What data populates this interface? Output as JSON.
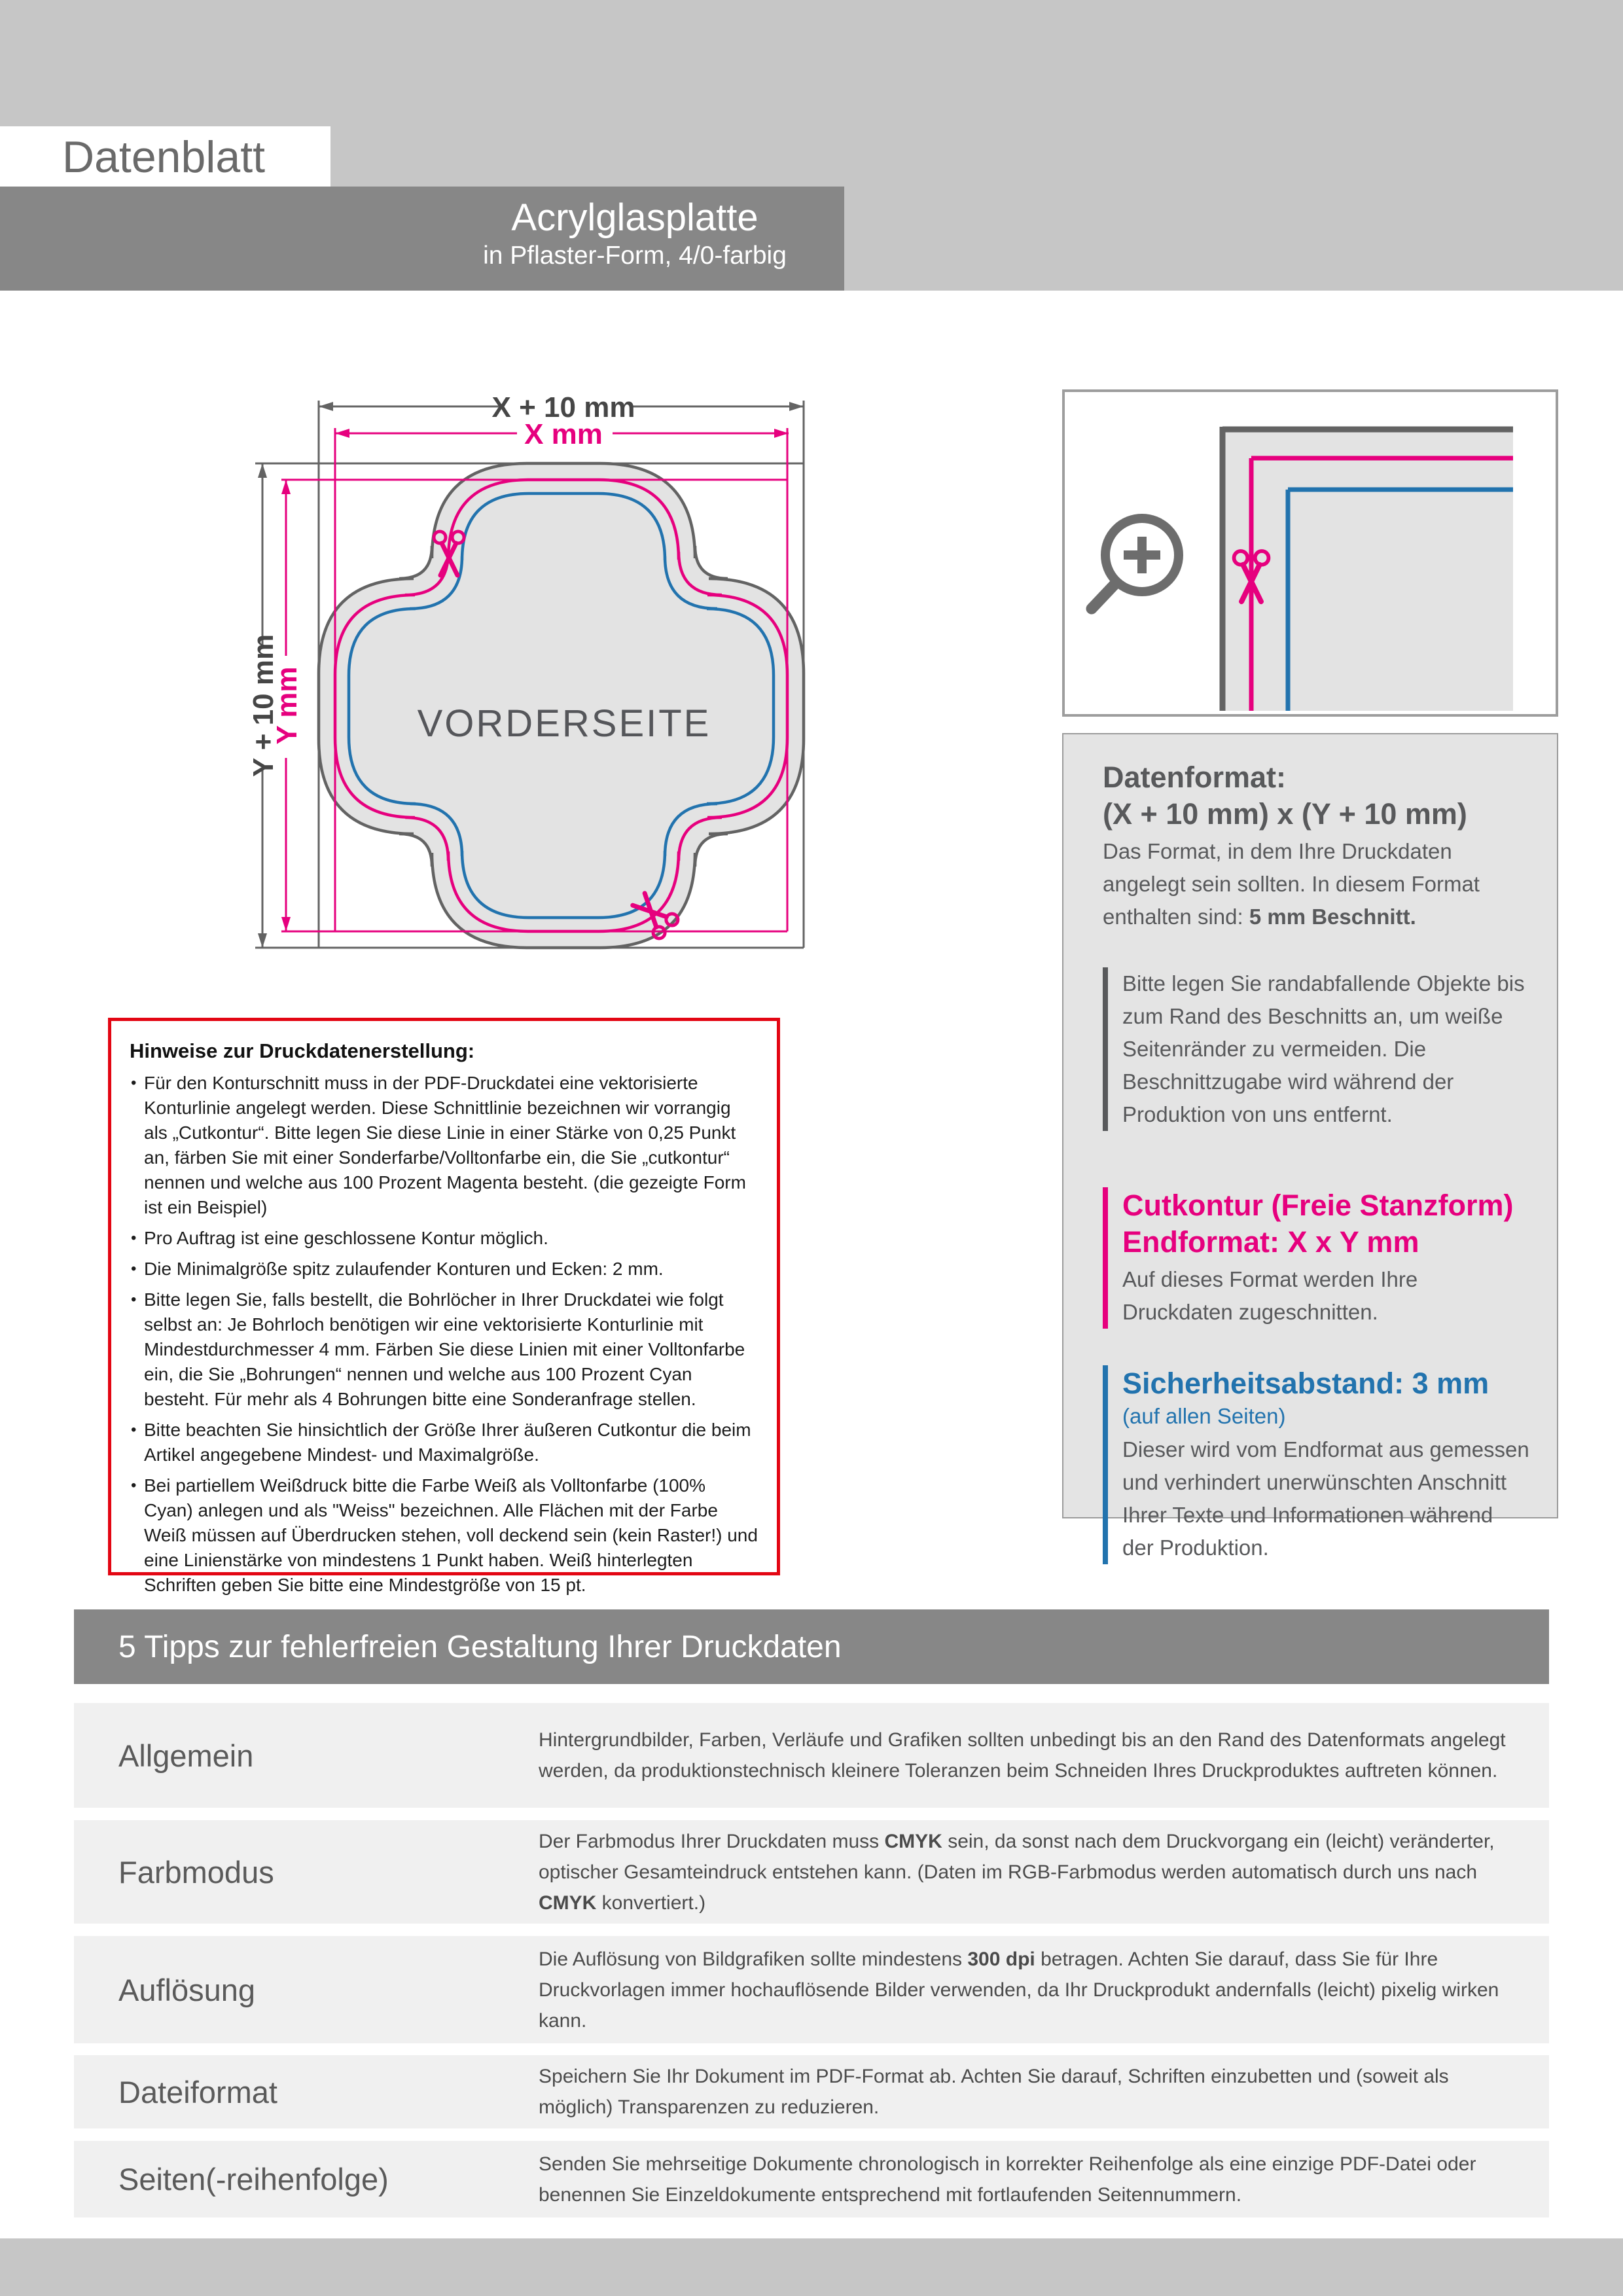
{
  "page": {
    "eyebrow": "Datenblatt",
    "title": "Acrylglasplatte",
    "subtitle": "in Pflaster-Form, 4/0-farbig"
  },
  "diagram": {
    "dim_outer_width": "X + 10 mm",
    "dim_inner_width": "X mm",
    "dim_outer_height": "Y + 10 mm",
    "dim_inner_height": "Y mm",
    "front_label": "VORDERSEITE"
  },
  "info_panel": {
    "datenformat_title": "Datenformat:",
    "datenformat_formula": "(X + 10 mm) x (Y + 10 mm)",
    "datenformat_segments": [
      {
        "t": "Das Format, in dem Ihre Druckdaten angelegt sein sollten. In diesem Format enthalten sind: ",
        "b": false
      },
      {
        "t": "5 mm Beschnitt.",
        "b": true
      }
    ],
    "bleed_note": "Bitte legen Sie randabfallende Objekte bis zum Rand des Beschnitts an, um weiße Seitenränder zu vermeiden. Die Beschnittzugabe wird während der Produktion von uns entfernt.",
    "cutkontur_title": "Cutkontur (Freie Stanzform)",
    "cutkontur_subtitle": "Endformat: X x Y mm",
    "cutkontur_text": "Auf dieses Format werden Ihre Druckdaten zugeschnitten.",
    "safety_title": "Sicherheitsabstand: 3 mm",
    "safety_scope": "(auf allen Seiten)",
    "safety_text": "Dieser wird vom Endformat aus gemessen und verhindert unerwünschten Anschnitt Ihrer Texte und Informationen während der Produktion."
  },
  "hinweise": {
    "title": "Hinweise zur Druckdatenerstellung:",
    "bullets": [
      "Für den Konturschnitt muss in der PDF-Druckdatei eine vektorisierte Konturlinie angelegt werden. Diese Schnittlinie bezeichnen wir vorrangig als „Cutkontur“. Bitte legen Sie diese Linie in einer Stärke von 0,25 Punkt an, färben Sie mit einer Sonderfarbe/Volltonfarbe ein, die Sie „cutkontur“ nennen und welche aus 100 Prozent Magenta besteht. (die gezeigte Form ist ein Beispiel)",
      "Pro Auftrag ist eine geschlossene Kontur möglich.",
      "Die Minimalgröße spitz zulaufender Konturen und Ecken: 2 mm.",
      "Bitte legen Sie, falls bestellt, die Bohrlöcher in Ihrer Druckdatei wie folgt selbst an: Je Bohrloch benötigen wir eine vektorisierte Konturlinie mit Mindestdurchmesser 4 mm. Färben Sie diese Linien mit einer Volltonfarbe ein, die Sie „Bohrungen“ nennen und welche aus 100 Prozent Cyan besteht. Für mehr als 4 Bohrungen bitte eine Sonderanfrage stellen.",
      "Bitte beachten Sie hinsichtlich der Größe Ihrer äußeren Cutkontur die beim Artikel angegebene Mindest- und Maximalgröße.",
      "Bei partiellem Weißdruck bitte die Farbe Weiß als Volltonfarbe (100% Cyan) anlegen und als \"Weiss\" bezeichnen. Alle Flächen mit der Farbe Weiß müssen auf Überdrucken stehen, voll deckend sein (kein Raster!) und eine Linienstärke von mindestens 1 Punkt haben. Weiß hinterlegten Schriften geben Sie bitte eine Mindestgröße von 15 pt."
    ]
  },
  "tips": {
    "banner": "5 Tipps zur fehlerfreien Gestaltung Ihrer Druckdaten",
    "rows": [
      {
        "label": "Allgemein",
        "segments": [
          {
            "t": "Hintergrundbilder, Farben, Verläufe und Grafiken sollten unbedingt bis an den Rand des Datenformats angelegt werden, da produktionstechnisch kleinere Toleranzen beim Schneiden Ihres Druckproduktes auftreten können.",
            "b": false
          }
        ]
      },
      {
        "label": "Farbmodus",
        "segments": [
          {
            "t": "Der Farbmodus Ihrer Druckdaten muss ",
            "b": false
          },
          {
            "t": "CMYK",
            "b": true
          },
          {
            "t": " sein, da sonst nach dem Druckvorgang ein (leicht) veränderter, optischer Gesamteindruck entstehen kann. (Daten im RGB-Farbmodus werden automatisch durch uns nach ",
            "b": false
          },
          {
            "t": "CMYK",
            "b": true
          },
          {
            "t": " konvertiert.)",
            "b": false
          }
        ]
      },
      {
        "label": "Auflösung",
        "segments": [
          {
            "t": "Die Auflösung von Bildgrafiken sollte mindestens ",
            "b": false
          },
          {
            "t": "300 dpi",
            "b": true
          },
          {
            "t": " betragen. Achten Sie darauf, dass Sie für Ihre Druckvorlagen immer hochauflösende Bilder verwenden, da Ihr Druckprodukt andernfalls (leicht) pixelig wirken kann.",
            "b": false
          }
        ]
      },
      {
        "label": "Dateiformat",
        "segments": [
          {
            "t": "Speichern Sie Ihr Dokument im PDF-Format ab. Achten Sie darauf, Schriften einzubetten und (soweit als möglich) Transparenzen zu reduzieren.",
            "b": false
          }
        ]
      },
      {
        "label": "Seiten(-reihenfolge)",
        "segments": [
          {
            "t": "Senden Sie mehrseitige Dokumente chronologisch in korrekter Reihenfolge als eine einzige PDF-Datei oder benennen Sie Einzeldokumente entsprechend mit fortlaufenden Seitennummern.",
            "b": false
          }
        ]
      }
    ]
  },
  "colors": {
    "band_gray": "#c6c6c6",
    "dark_band": "#878787",
    "magenta": "#e6007e",
    "blue": "#2273ae",
    "red": "#e30613",
    "ink": "#58595b",
    "contour_gray": "#636363",
    "shape_fill": "#e3e3e3",
    "row_bg": "#f0f0f0",
    "panel_bg": "#e4e4e4"
  }
}
